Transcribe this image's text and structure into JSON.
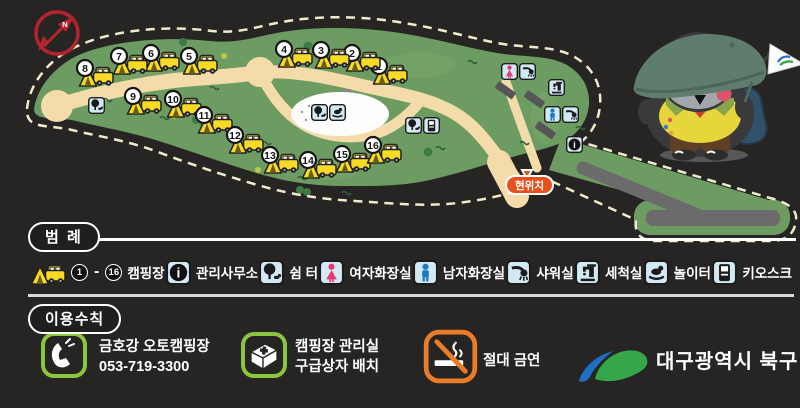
{
  "compass": {
    "label": "N"
  },
  "map": {
    "current_location_label": "현위치",
    "sites": [
      {
        "n": "1",
        "x": 372,
        "y": 60
      },
      {
        "n": "2",
        "x": 345,
        "y": 47
      },
      {
        "n": "3",
        "x": 314,
        "y": 44
      },
      {
        "n": "4",
        "x": 277,
        "y": 43
      },
      {
        "n": "5",
        "x": 182,
        "y": 50
      },
      {
        "n": "6",
        "x": 144,
        "y": 47
      },
      {
        "n": "7",
        "x": 112,
        "y": 50
      },
      {
        "n": "8",
        "x": 78,
        "y": 62
      },
      {
        "n": "9",
        "x": 126,
        "y": 90
      },
      {
        "n": "10",
        "x": 166,
        "y": 93
      },
      {
        "n": "11",
        "x": 197,
        "y": 109
      },
      {
        "n": "12",
        "x": 228,
        "y": 129
      },
      {
        "n": "13",
        "x": 263,
        "y": 149
      },
      {
        "n": "14",
        "x": 301,
        "y": 154
      },
      {
        "n": "15",
        "x": 335,
        "y": 148
      },
      {
        "n": "16",
        "x": 366,
        "y": 139
      }
    ],
    "facilities": [
      {
        "type": "shelter",
        "x": 88,
        "y": 97
      },
      {
        "type": "shelter",
        "x": 311,
        "y": 104
      },
      {
        "type": "playground",
        "x": 329,
        "y": 104
      },
      {
        "type": "shelter",
        "x": 405,
        "y": 117
      },
      {
        "type": "kiosk",
        "x": 423,
        "y": 117
      },
      {
        "type": "toilet-female",
        "x": 501,
        "y": 63
      },
      {
        "type": "shower",
        "x": 519,
        "y": 63
      },
      {
        "type": "washing",
        "x": 548,
        "y": 79
      },
      {
        "type": "toilet-male",
        "x": 544,
        "y": 106
      },
      {
        "type": "shower",
        "x": 562,
        "y": 106
      },
      {
        "type": "info",
        "x": 566,
        "y": 136
      }
    ]
  },
  "legend": {
    "title": "범 례",
    "camping_from": "1",
    "camping_to": "16",
    "range_dash": "-",
    "items": [
      {
        "id": "camping",
        "label": "캠핑장"
      },
      {
        "id": "office",
        "label": "관리사무소"
      },
      {
        "id": "shelter",
        "label": "쉼 터"
      },
      {
        "id": "toilet-female",
        "label": "여자화장실"
      },
      {
        "id": "toilet-male",
        "label": "남자화장실"
      },
      {
        "id": "shower",
        "label": "샤워실"
      },
      {
        "id": "washing",
        "label": "세척실"
      },
      {
        "id": "playground",
        "label": "놀이터"
      },
      {
        "id": "kiosk",
        "label": "키오스크"
      }
    ]
  },
  "rules": {
    "title": "이용수칙",
    "phone": {
      "name": "금호강 오토캠핑장",
      "number": "053-719-3300"
    },
    "first_aid": {
      "line1": "캠핑장 관리실",
      "line2": "구급상자 배치"
    },
    "no_smoking": {
      "label": "절대 금연"
    },
    "organization": {
      "label": "대구광역시 북구"
    }
  },
  "colors": {
    "background": "#272424",
    "map_green": "#6d9c62",
    "road_tan": "#f4dcaa",
    "site_yellow": "#f7d928",
    "icon_bg_blue": "#d2e9f4",
    "female_pink": "#e8376e",
    "male_blue": "#1f7ac4",
    "current_location_bg": "#e8501e",
    "compass_red": "#b3242e",
    "rule_icon_green": "#8cc63f",
    "no_smoking_orange": "#e87c28",
    "logo_blue": "#1f6fc4",
    "logo_green": "#35a649"
  }
}
